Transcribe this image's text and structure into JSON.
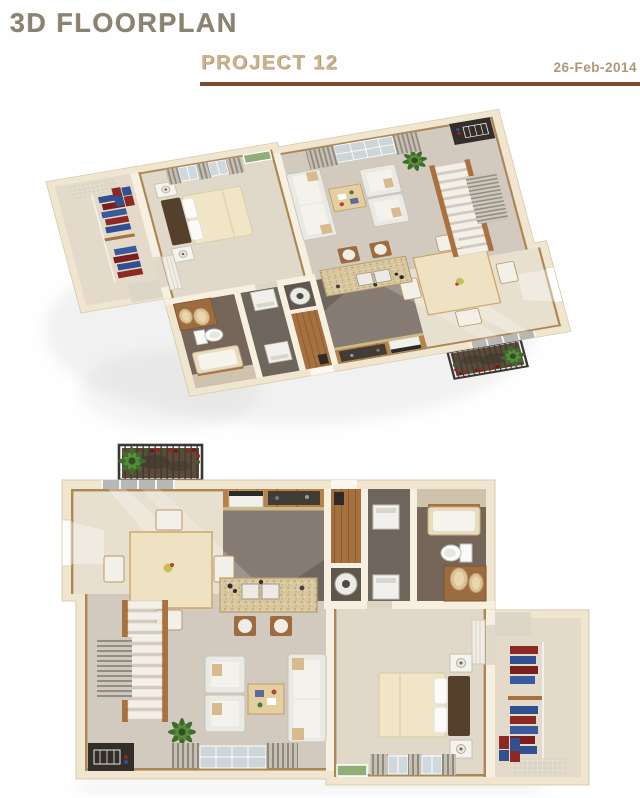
{
  "header": {
    "title": "3D FLOORPLAN",
    "subtitle": "PROJECT 12",
    "date": "26-Feb-2014"
  },
  "views": {
    "top": {
      "name": "3D isometric floorplan render",
      "rooms": [
        "bedroom",
        "walk-in-closet",
        "living-room",
        "kitchen",
        "dining-area",
        "bathroom",
        "laundry",
        "entry-hall",
        "stairs",
        "balcony"
      ]
    },
    "bottom": {
      "name": "Top-down floorplan render",
      "rooms": [
        "bedroom",
        "walk-in-closet",
        "living-room",
        "kitchen",
        "dining-area",
        "bathroom",
        "laundry",
        "entry-hall",
        "stairs",
        "balcony"
      ]
    }
  },
  "furniture": [
    "double-bed",
    "nightstands",
    "hanging-clothes",
    "sofa",
    "armchairs",
    "coffee-table",
    "potted-plants",
    "dining-table",
    "dining-chairs",
    "kitchen-island-with-sinks",
    "bar-stools",
    "stove",
    "washer",
    "dryer",
    "water-heater",
    "bathtub",
    "toilet",
    "double-sink-vanity",
    "staircase",
    "balcony-flower-boxes"
  ],
  "palette": {
    "heading": "#8b8270",
    "subtitle": "#cbb28c",
    "date": "#b29577",
    "rule": "#7c4a31",
    "walls": "#f0e6d0",
    "interior_walls": "#f7f0e1",
    "dining_floor": "#e8e0cf",
    "living_floor": "#d2cabe",
    "bedroom_floor": "#e0d8c8",
    "kitchen_floor": "#6e655d",
    "bath_floor": "#756659",
    "wood_trim": "#a8713f",
    "granite": "#d9c89f",
    "bed_duvet": "#f0e6c6",
    "headboard": "#55402c",
    "sofa": "#ebe9e3",
    "plant_green": "#3f6b2d",
    "flower_red": "#9c211c",
    "clothes_red": "#8e2824",
    "clothes_blue": "#31508f",
    "balcony_floor": "#5c4a3a"
  }
}
